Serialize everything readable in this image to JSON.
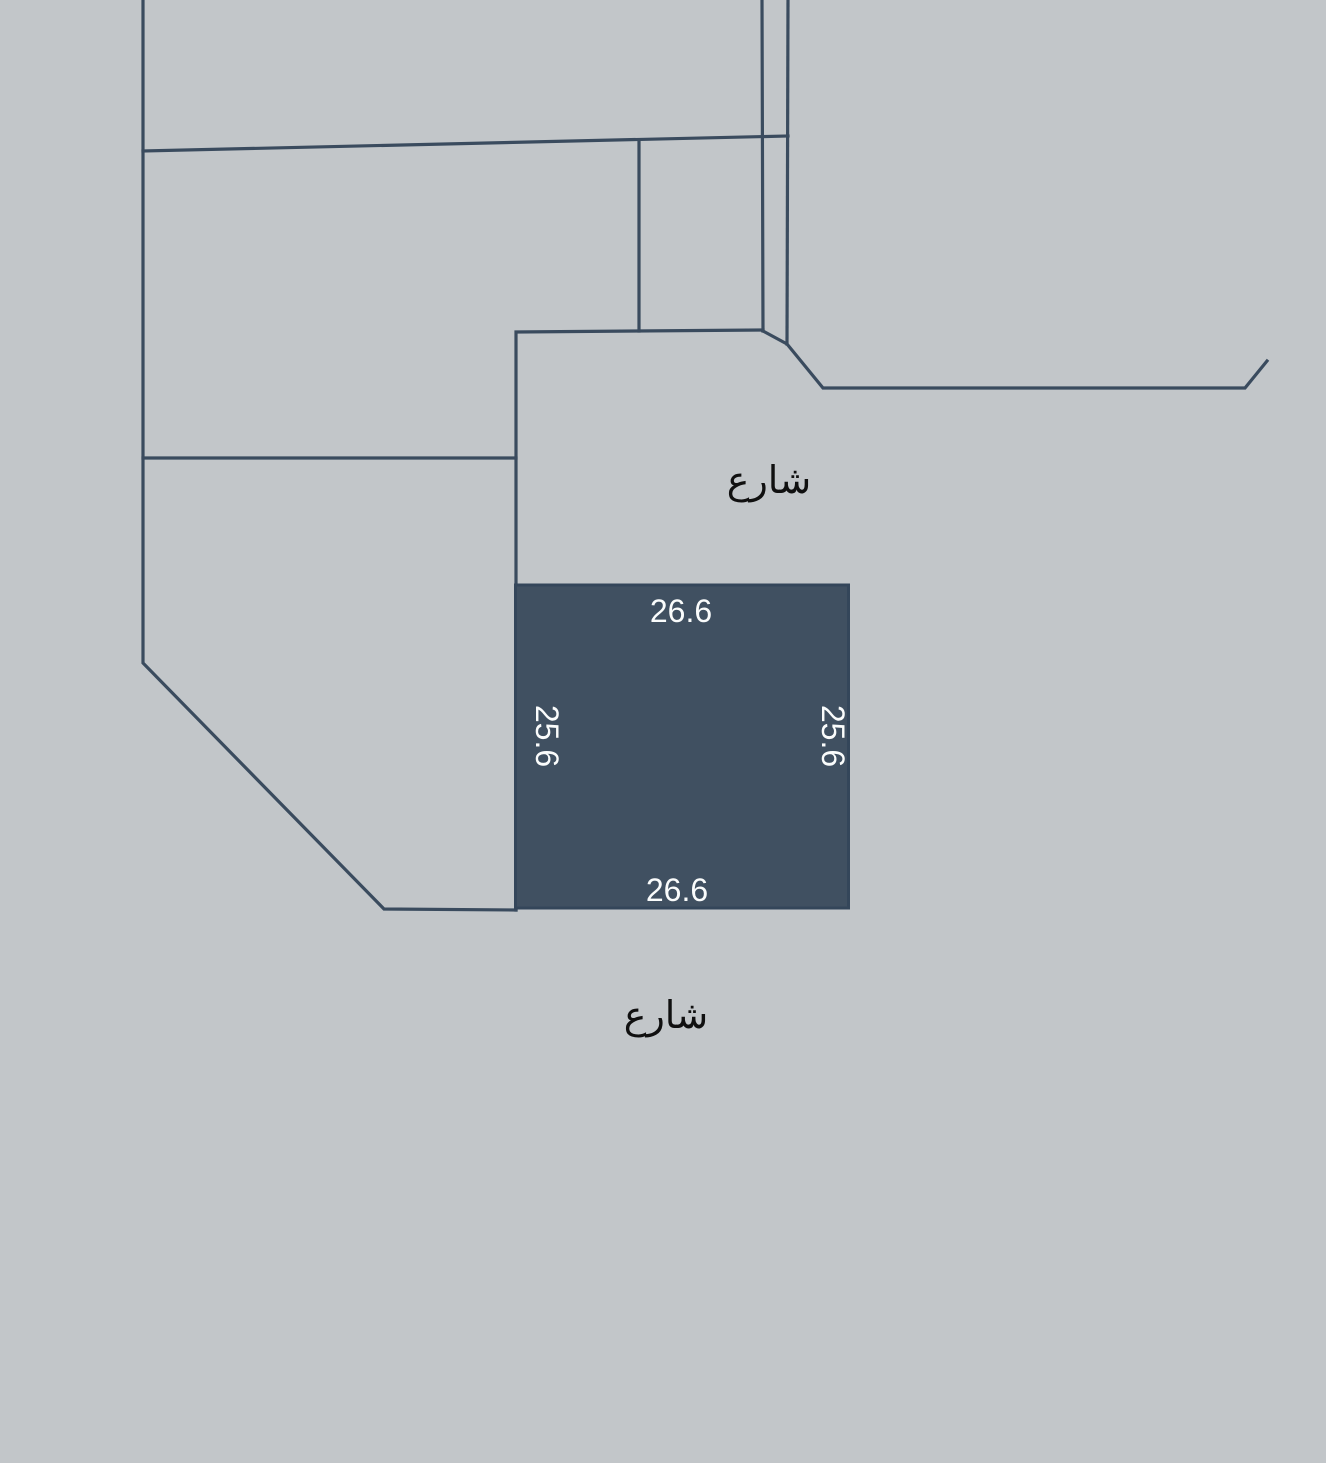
{
  "map": {
    "street_label_top": "شارع",
    "street_label_bottom": "شارع",
    "parcel": {
      "dim_top": "26.6",
      "dim_bottom": "26.6",
      "dim_left": "25.6",
      "dim_right": "25.6"
    },
    "colors": {
      "background": "#c2c6c9",
      "boundary_line": "#3a4b5e",
      "parcel_fill": "#405061",
      "parcel_stroke": "#34465a",
      "dimension_text": "#fafcfc",
      "street_text": "#101010"
    }
  }
}
